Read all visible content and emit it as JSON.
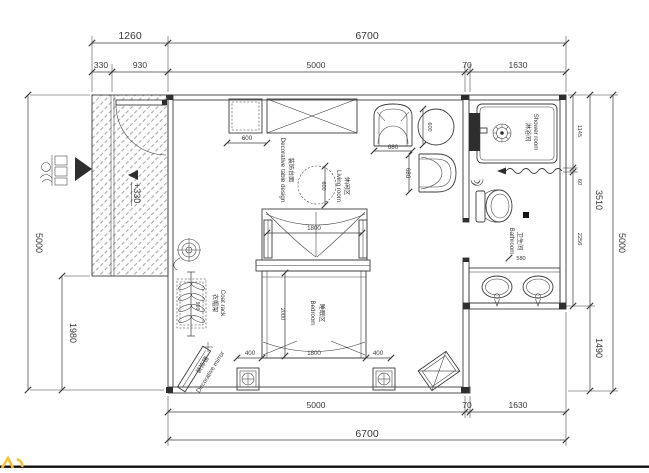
{
  "page": {
    "bg": "#ffffff",
    "line_color": "#3c3c3c",
    "accent_yellow": "#f2c330"
  },
  "dims": {
    "top_1260": "1260",
    "top_6700": "6700",
    "top_330": "330",
    "top_930": "930",
    "top_5000": "5000",
    "top_70": "70",
    "top_1630": "1630",
    "bottom_5000": "5000",
    "bottom_70": "70",
    "bottom_1630": "1630",
    "bottom_6700": "6700",
    "left_5000": "5000",
    "left_1980": "1980",
    "right_1145": "1145",
    "right_60": "60",
    "right_2256": "2256",
    "right_3510": "3510",
    "right_1490": "1490",
    "right_5000": "5000",
    "cabinet_600": "600",
    "round_table_600": "600",
    "side_table_600": "600",
    "armchair_top_680": "680",
    "armchair_side_680": "680",
    "canopy_1800": "1800",
    "bed_2000": "2000",
    "bed_1800": "1800",
    "bed_left_400": "400",
    "bed_right_400": "400",
    "vanity_580": "580",
    "coat_rack_900": "900",
    "elevation": "+330"
  },
  "rooms": {
    "shower_cn": "淋浴间",
    "shower_en": "Shower room",
    "bathroom_cn": "卫生间",
    "bathroom_en": "Bathroom",
    "living_cn": "休闲区",
    "living_en": "Living room",
    "bedroom_cn": "睡眠区",
    "bedroom_en": "Bedroom"
  },
  "items": {
    "coat_rack_cn": "衣帽架",
    "coat_rack_en": "Coat rack",
    "mirror_cn": "装饰镜",
    "mirror_en": "Decorative mirror",
    "console_cn": "装饰台面",
    "console_en": "Decorative table design"
  }
}
